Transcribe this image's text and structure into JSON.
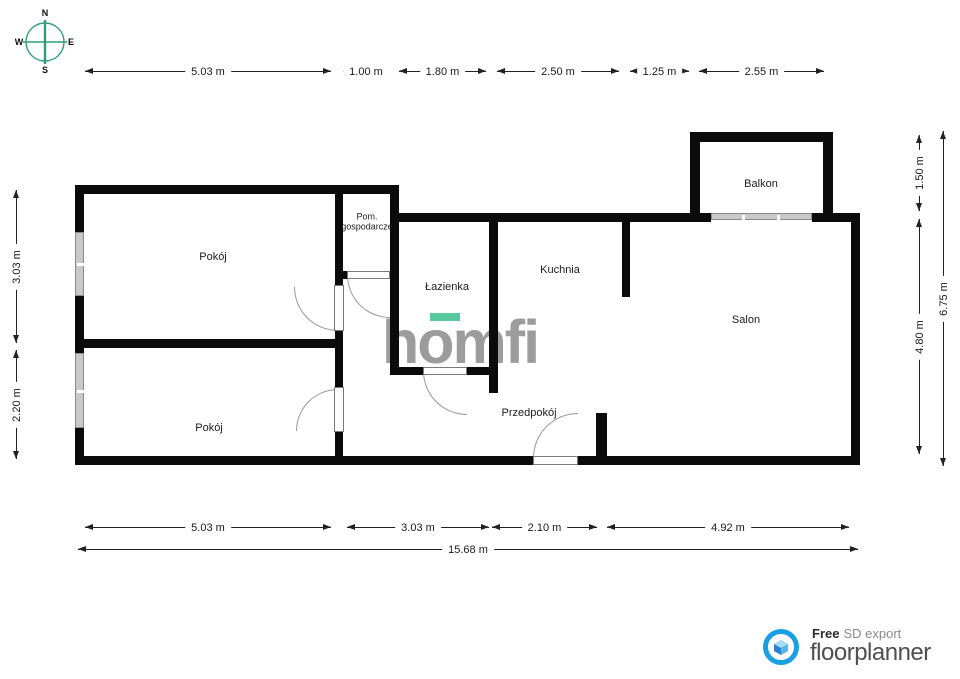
{
  "compass": {
    "north": "N",
    "east": "E",
    "south": "S",
    "west": "W"
  },
  "rooms": {
    "pokoj_top": "Pokój",
    "pom_gospodarcze": "Pom. gospodarcze",
    "lazienka": "Łazienka",
    "kuchnia": "Kuchnia",
    "balkon": "Balkon",
    "salon": "Salon",
    "pokoj_bottom": "Pokój",
    "przedpokoj": "Przedpokój"
  },
  "dimensions": {
    "top": [
      "5.03 m",
      "1.00 m",
      "1.80 m",
      "2.50 m",
      "1.25 m",
      "2.55 m"
    ],
    "bottom": [
      "5.03 m",
      "3.03 m",
      "2.10 m",
      "4.92 m"
    ],
    "bottom_total": "15.68 m",
    "left": [
      "3.03 m",
      "2.20 m"
    ],
    "right_inner": [
      "1.50 m",
      "4.80 m"
    ],
    "right_outer": "6.75 m"
  },
  "watermark": {
    "text": "homfi",
    "accent_color": "#57c9a1",
    "text_color": "#9c9c9c"
  },
  "branding": {
    "free_label": "Free",
    "export_label": "SD export",
    "brand_name": "floorplanner",
    "brand_color": "#19a0e3",
    "brand_text_color": "#4f4f4f"
  },
  "compass_color": "#2f9e78"
}
